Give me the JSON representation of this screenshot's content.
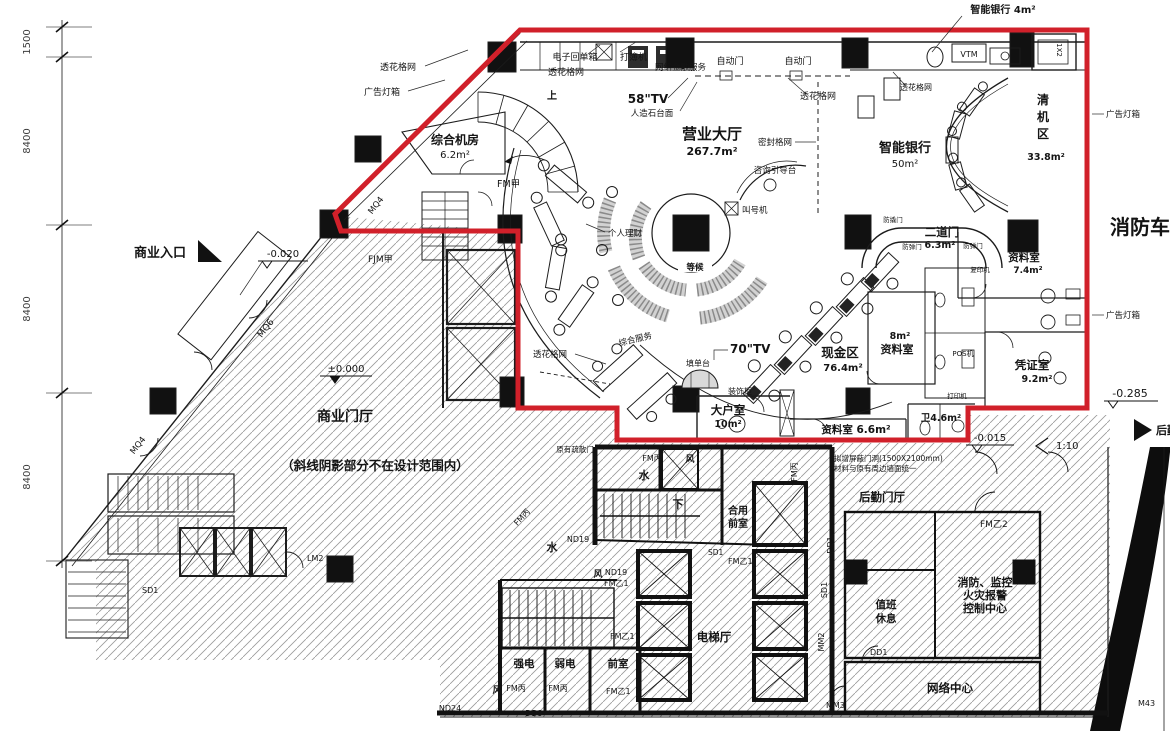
{
  "colors": {
    "scope_red": "#d1202a",
    "line": "#1c1c1c",
    "hatch": "#8f8f8f"
  },
  "dims": {
    "d1500": "1500",
    "d8400": "8400"
  },
  "levels": {
    "e020": "-0.020",
    "e000": "±0.000",
    "e285": "-0.285",
    "e015": "-0.015",
    "ramp": "1:10"
  },
  "notes": {
    "scope": "（斜线阴影部分不在设计范围内）",
    "door1": "拟增屏蔽门洞(1500X2100mm)",
    "door2": "材料与原有周边墙面统一"
  },
  "rooms": {
    "hall_name": "营业大厅",
    "hall_area": "267.7m²",
    "smart_name": "智能银行",
    "smart_area": "50m²",
    "smart_small": "智能银行 4m²",
    "clear_c1": "清",
    "clear_c2": "机",
    "clear_c3": "区",
    "clear_area": "33.8m²",
    "server_name": "综合机房",
    "server_area": "6.2m²",
    "door2_name": "二道门",
    "door2_area": "6.3m²",
    "data74_name": "资料室",
    "data74_area": "7.4m²",
    "data8_name": "资料室",
    "data8_area": "8m²",
    "voucher_name": "凭证室",
    "voucher_area": "9.2m²",
    "cash_name": "现金区",
    "cash_area": "76.4m²",
    "vip_name": "大户室",
    "vip_area": "10m²",
    "data66": "资料室 6.6m²",
    "wc": "卫4.6m²",
    "biz_lobby": "商业门厅",
    "biz_entry": "商业入口",
    "fire_lane": "消防车道",
    "log_lobby": "后勤门厅",
    "fire_c1": "消防、监控",
    "fire_c2": "火灾报警",
    "fire_c3": "控制中心",
    "duty1": "值班",
    "duty2": "休息",
    "network": "网络中心",
    "lift_hall": "电梯厅",
    "strong": "强电",
    "weak": "弱电",
    "ante": "前室",
    "shared1": "合用",
    "shared2": "前室",
    "water": "水",
    "air": "风",
    "down": "下",
    "up": "上",
    "rear_exit": "后勤出入口"
  },
  "equip": {
    "grille": "透花格网",
    "lightbox": "广告灯箱",
    "receipt": "电子回单箱",
    "passbook": "打簿机",
    "netfin": "网络金融服务",
    "autodoor": "自动门",
    "tv58": "58\"TV",
    "stone": "人造石台面",
    "infodesk": "咨询引导台",
    "caller": "叫号机",
    "pf": "个人理财",
    "wait": "等候",
    "service": "综合服务",
    "tv70": "70\"TV",
    "formdesk": "填单台",
    "cabinet": "装饰柜",
    "pos": "POS机",
    "printer": "打印机",
    "copier": "复印机",
    "vtm": "VTM",
    "sealed": "密封格网",
    "bullet": "防弹门",
    "pry": "防撬门",
    "origdoor": "原有疏散门",
    "booth": "1X2"
  },
  "doors": {
    "fm_a": "FM甲",
    "fjm_a": "FJM甲",
    "fm_b1": "FM乙1",
    "fm_b2": "FM乙2",
    "fm_c": "FM丙",
    "mq6": "MQ6",
    "mq4": "MQ4",
    "lm2": "LM2",
    "sd1": "SD1",
    "dd1": "DD1",
    "dd3": "DD3",
    "nd19": "ND19",
    "nd24": "ND24",
    "mm2": "MM2",
    "mm3": "MM3",
    "m43": "M43"
  }
}
